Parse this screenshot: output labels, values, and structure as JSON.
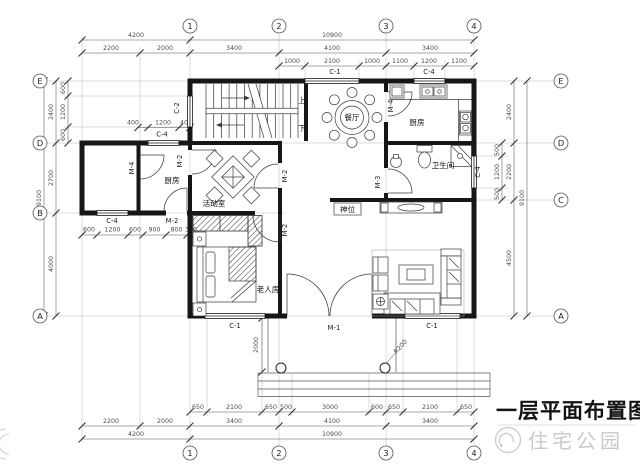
{
  "title": "一层平面布置图",
  "watermark": {
    "brand": "住宅公园"
  },
  "axes": {
    "top": [
      "1",
      "2",
      "3",
      "4"
    ],
    "bottom": [
      "1",
      "2",
      "3",
      "4"
    ],
    "left": [
      "E",
      "D",
      "B",
      "A"
    ],
    "right": [
      "E",
      "D",
      "C",
      "A"
    ]
  },
  "rooms": {
    "dining": "餐厅",
    "kitchen": "厨房",
    "kitchen_annex": "厨房",
    "bathroom": "卫生间",
    "activity": "活动室",
    "elder_bedroom": "老人房",
    "shrine": "神位",
    "stair_up": "上",
    "stair_down": "下"
  },
  "openings": {
    "m1": "M-1",
    "m2": "M-2",
    "m3": "M-3",
    "m4": "M-4",
    "c1": "C-1",
    "c2": "C-2",
    "c4": "C-4"
  },
  "dimensions": {
    "top_total": [
      "4200",
      "10900"
    ],
    "top_main": [
      "2200",
      "2000",
      "3400",
      "4100",
      "3400"
    ],
    "top_detail": [
      "1000",
      "2100",
      "1000",
      "1100",
      "1200",
      "1100"
    ],
    "bottom_detail": [
      "650",
      "2100",
      "650",
      "500",
      "3000",
      "600",
      "650",
      "2100",
      "650"
    ],
    "bottom_main": [
      "2200",
      "2000",
      "3400",
      "4100",
      "3400"
    ],
    "bottom_total": [
      "4200",
      "10900"
    ],
    "left_total": "9100",
    "left_main": [
      "2400",
      "2700",
      "4000"
    ],
    "left_detail": [
      "600",
      "1200",
      "600"
    ],
    "right_total": "9100",
    "right_main": [
      "2400",
      "2200",
      "4500"
    ],
    "right_detail": [
      "500",
      "1200",
      "500"
    ],
    "annex_top_detail": [
      "400",
      "1200",
      "400"
    ],
    "annex_bottom_detail": [
      "600",
      "1200",
      "600",
      "900",
      "800",
      "300"
    ],
    "porch_depth": "2000",
    "column_radius": "R200"
  }
}
